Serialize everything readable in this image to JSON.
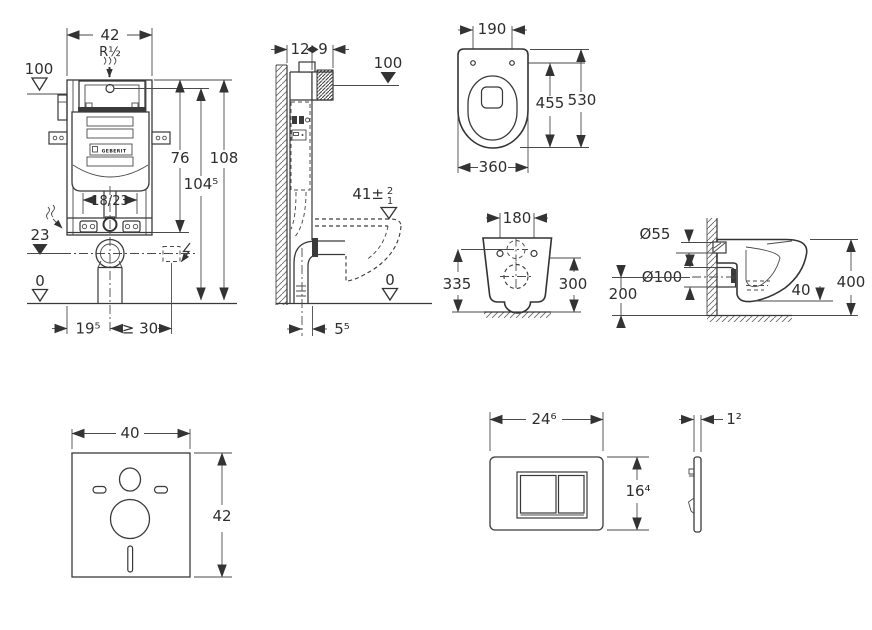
{
  "sheet": {
    "background": "#ffffff",
    "line_color": "#333333",
    "text_color": "#2e2e2e"
  },
  "frame_front_view": {
    "width_top": "42",
    "water_thread": "R½",
    "level_100": "100",
    "height_76": "76",
    "height_104_5": "104⁵",
    "height_108": "108",
    "spread_18_23": "18/23",
    "level_23": "23",
    "level_0": "0",
    "offset_19_5": "19⁵",
    "offset_min_30": "≥ 30",
    "brand": "GEBERIT"
  },
  "frame_side_view": {
    "depth_12": "12",
    "depth_9": "9",
    "level_100": "100",
    "seat_height": "41±",
    "tol_up": "2",
    "tol_dn": "1",
    "level_0": "0",
    "offset_5_5": "5⁵"
  },
  "wc_top_view": {
    "holes_190": "190",
    "length_455": "455",
    "length_530": "530",
    "width_360": "360"
  },
  "wc_rear_view": {
    "holes_180": "180",
    "height_335": "335",
    "height_300": "300"
  },
  "wc_side_view": {
    "inlet_dia": "Ø55",
    "outlet_dia": "Ø100",
    "height_200": "200",
    "gap_40": "40",
    "height_400": "400"
  },
  "sound_mat_view": {
    "width_40": "40",
    "height_42": "42"
  },
  "flush_plate_front_view": {
    "width_24_6": "24⁶",
    "height_16_4": "16⁴"
  },
  "flush_plate_side_view": {
    "thickness_1_2": "1²"
  }
}
